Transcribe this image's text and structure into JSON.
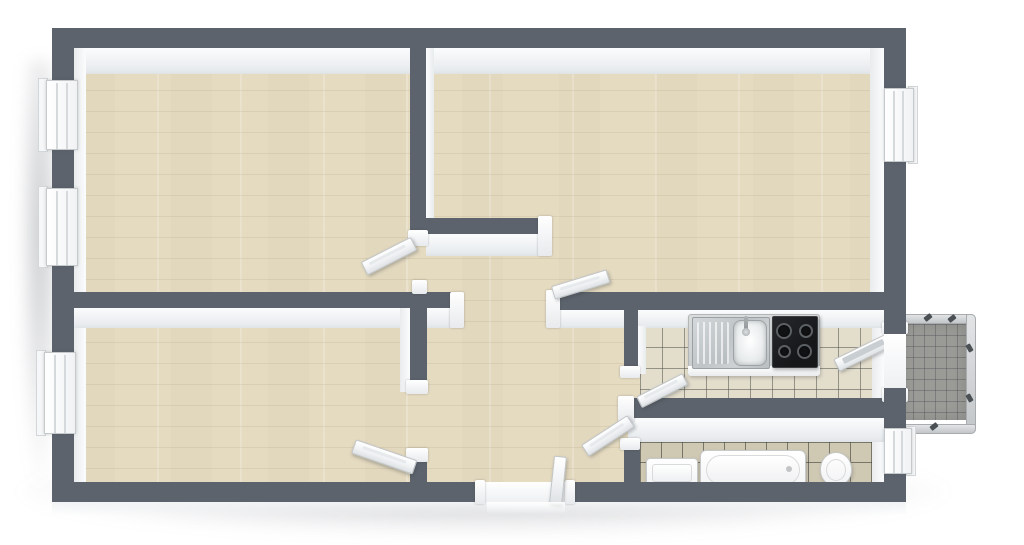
{
  "image": {
    "kind": "3d-floor-plan-rendering",
    "view": "top-down isometric",
    "visible_text": "none",
    "background": "#ffffff"
  },
  "palette": {
    "wall": "#5c636c",
    "wood": "#e8dfc7",
    "kitchenTile": "#e3ddcc",
    "bathTile": "#cfc8b3",
    "balconyFloor": "#9a9a97",
    "railing": "#d3d5d7",
    "fixtureWhite": "#ffffff",
    "cooktopBlack": "#1d1f21",
    "steel": "#c6cacc"
  },
  "rooms": [
    {
      "id": "room-top-left",
      "floor": "hardwood-plank",
      "windows": 2,
      "doors": 1
    },
    {
      "id": "room-top-right",
      "floor": "hardwood-plank",
      "windows": 1,
      "doors": 1
    },
    {
      "id": "room-bottom-left",
      "floor": "hardwood-plank",
      "windows": 1,
      "doors": 1
    },
    {
      "id": "hallway",
      "floor": "hardwood-plank",
      "doors": [
        "entrance",
        "room-top-left",
        "room-top-right",
        "room-bottom-left",
        "kitchen",
        "bathroom"
      ]
    },
    {
      "id": "kitchen",
      "floor": "light-square-tile",
      "fixtures": [
        "counter",
        "sink-with-drainboard",
        "faucet",
        "cooktop-4-burners"
      ],
      "doors": [
        "hallway",
        "balcony"
      ]
    },
    {
      "id": "bathroom",
      "floor": "beige-square-tile",
      "fixtures": [
        "washbasin",
        "bathtub",
        "toilet"
      ],
      "windows": 1,
      "doors": 1
    },
    {
      "id": "balcony",
      "floor": "gray-grid-tile",
      "features": [
        "metal-railing",
        "railing-posts"
      ],
      "access": "kitchen"
    }
  ],
  "counts": {
    "windows": 5,
    "interior-door-leaves": 6,
    "entrance-doors": 1,
    "balcony-doors": 1
  }
}
